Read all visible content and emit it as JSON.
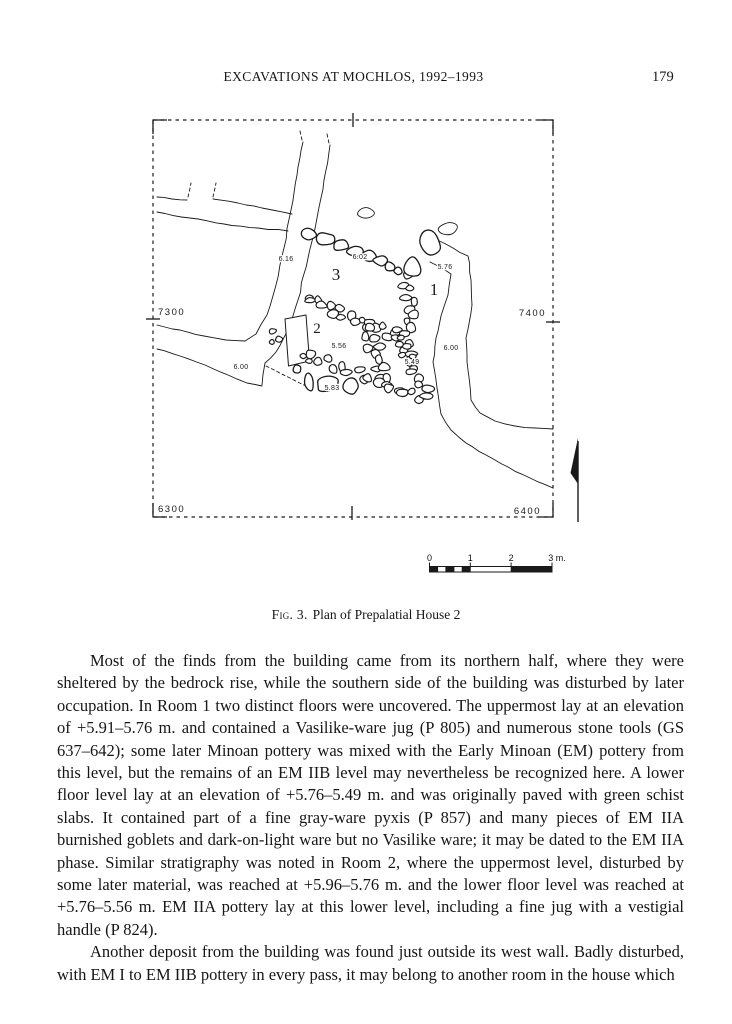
{
  "header": {
    "title": "EXCAVATIONS AT MOCHLOS, 1992–1993",
    "page_number": "179"
  },
  "figure": {
    "caption_label": "Fig. 3.",
    "caption_text": "Plan of Prepalatial House 2",
    "plan": {
      "grid": {
        "nw": "7300",
        "ne": "7400",
        "sw": "6300",
        "se": "6400"
      },
      "rooms": {
        "r1": "1",
        "r2": "2",
        "r3": "3"
      },
      "elev": {
        "e616": "6.16",
        "e602": "6.02",
        "e576": "5.76",
        "e556": "5.56",
        "e549": "5.49",
        "e600a": "6.00",
        "e600b": "6.00",
        "e583": "5.83"
      },
      "scale": {
        "t0": "0",
        "t1": "1",
        "t2": "2",
        "t3": "3 m."
      }
    }
  },
  "body": {
    "paragraphs": [
      "Most of the finds from the building came from its northern half, where they were sheltered by the bedrock rise, while the southern side of the building was disturbed by later occupation. In Room 1 two distinct floors were uncovered. The uppermost lay at an elevation of +5.91–5.76 m. and contained a Vasilike-ware jug (P 805) and numerous stone tools (GS 637–642); some later Minoan pottery was mixed with the Early Minoan (EM) pottery from this level, but the remains of an EM IIB level may nevertheless be recognized here. A lower floor level lay at an elevation of +5.76–5.49 m. and was originally paved with green schist slabs. It contained part of a fine gray-ware pyxis (P 857) and many pieces of EM IIA burnished goblets and dark-on-light ware but no Vasilike ware; it may be dated to the EM IIA phase. Similar stratigraphy was noted in Room 2, where the uppermost level, disturbed by some later material, was reached at +5.96–5.76 m. and the lower floor level was reached at +5.76–5.56 m. EM IIA pottery lay at this lower level, including a fine jug with a vestigial handle (P 824).",
      "Another deposit from the building was found just outside its west wall. Badly disturbed, with EM I to EM IIB pottery in every pass, it may belong to another room in the house which"
    ]
  }
}
